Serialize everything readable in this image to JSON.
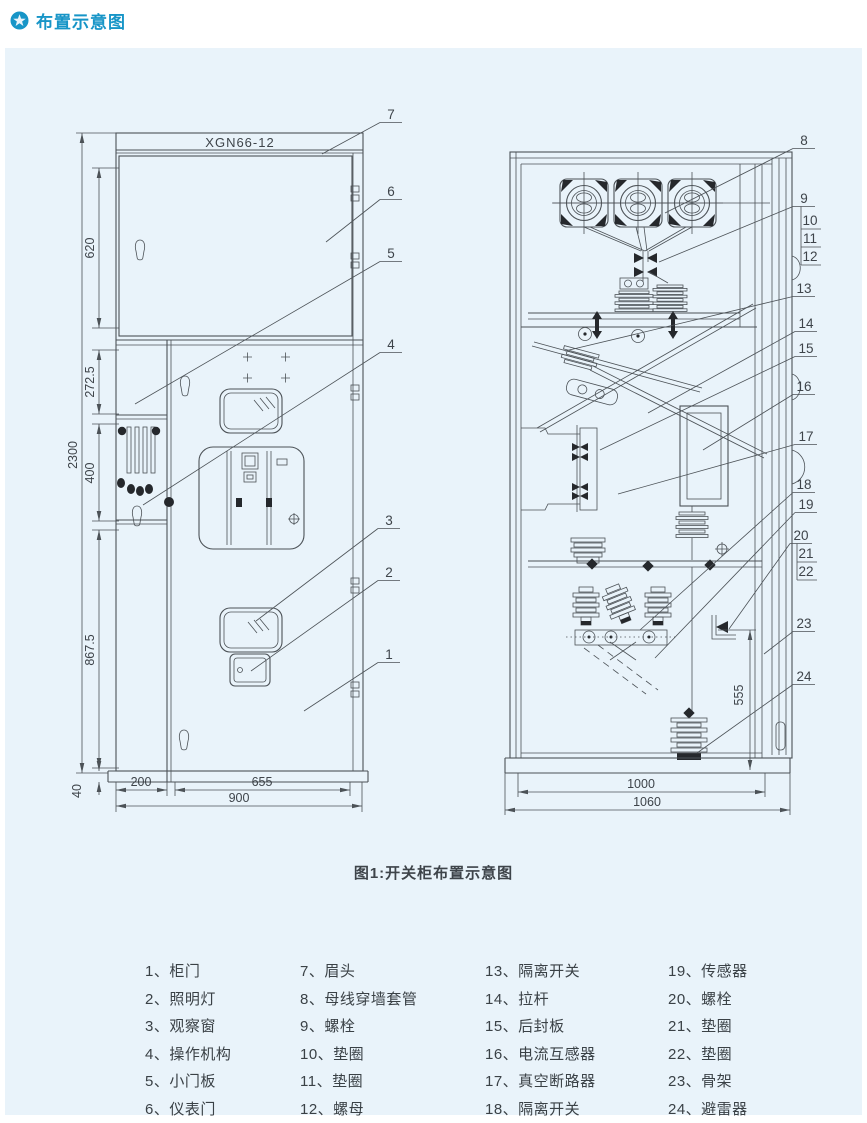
{
  "header": {
    "title": "布置示意图",
    "icon": "star-badge-icon",
    "accent_color": "#1795c7"
  },
  "figure": {
    "caption": "图1:开关柜布置示意图",
    "left_view": {
      "model": "XGN66-12",
      "dims": {
        "total": "2300",
        "top": "620",
        "upper": "272.5",
        "middle": "400",
        "lower": "867.5",
        "base": "40",
        "col": "200",
        "door": "655",
        "width": "900"
      },
      "callouts": [
        "1",
        "2",
        "3",
        "4",
        "5",
        "6",
        "7"
      ]
    },
    "right_view": {
      "dims": {
        "height": "555",
        "inner_width": "1000",
        "outer_width": "1060"
      },
      "callouts": [
        "8",
        "9",
        "10",
        "11",
        "12",
        "13",
        "14",
        "15",
        "16",
        "17",
        "18",
        "19",
        "20",
        "21",
        "22",
        "23",
        "24"
      ]
    }
  },
  "legend": {
    "columns": [
      {
        "items": [
          "1、柜门",
          "2、照明灯",
          "3、观察窗",
          "4、操作机构",
          "5、小门板",
          "6、仪表门"
        ]
      },
      {
        "items": [
          "7、眉头",
          "8、母线穿墙套管",
          "9、螺栓",
          "10、垫圈",
          "11、垫圈",
          "12、螺母"
        ]
      },
      {
        "items": [
          "13、隔离开关",
          "14、拉杆",
          "15、后封板",
          "16、电流互感器",
          "17、真空断路器",
          "18、隔离开关"
        ]
      },
      {
        "items": [
          "19、传感器",
          "20、螺栓",
          "21、垫圈",
          "22、垫圈",
          "23、骨架",
          "24、避雷器"
        ]
      }
    ]
  },
  "colors": {
    "panel_bg": "#e9f3fa",
    "line": "#4c5257",
    "text": "#3e444a"
  }
}
